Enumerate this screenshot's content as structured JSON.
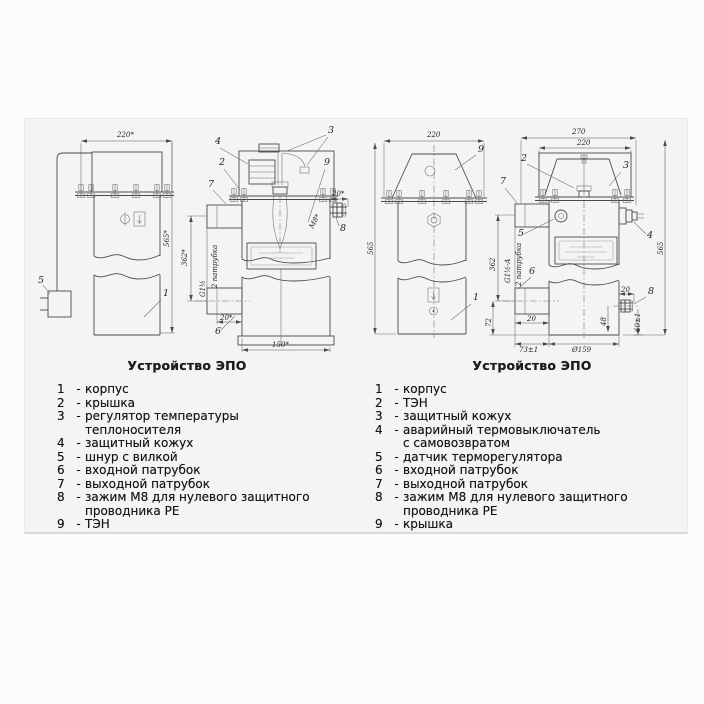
{
  "ui": {
    "dash": "-"
  },
  "fig1": {
    "caption": "Устройство ЭПО",
    "dims": {
      "top_width": "220*",
      "height": "565*",
      "mid_height": "362*",
      "bottom_width": "150*",
      "stud_thread": "М8*",
      "stud_len": "20*",
      "pipe_len": "20*",
      "pipe_thread": "G1½",
      "pipe_note": "2 патрубка"
    },
    "callouts": {
      "c1": "1",
      "c2": "2",
      "c3": "3",
      "c4": "4",
      "c5": "5",
      "c6": "6",
      "c7": "7",
      "c8": "8",
      "c9": "9"
    },
    "parts": [
      {
        "n": "1",
        "t": "корпус"
      },
      {
        "n": "2",
        "t": "крышка"
      },
      {
        "n": "3",
        "t": "регулятор температуры теплоносителя"
      },
      {
        "n": "4",
        "t": "защитный кожух"
      },
      {
        "n": "5",
        "t": "шнур с вилкой"
      },
      {
        "n": "6",
        "t": "входной патрубок"
      },
      {
        "n": "7",
        "t": "выходной патрубок"
      },
      {
        "n": "8",
        "t": "зажим М8 для нулевого защитного проводника РЕ"
      },
      {
        "n": "9",
        "t": "ТЭН"
      }
    ]
  },
  "fig2": {
    "caption": "Устройство ЭПО",
    "dims": {
      "outer_width": "270",
      "top_width": "220",
      "height": "565",
      "height_right": "565",
      "mid_height": "362",
      "inlet_offset": "72",
      "bottom_left": "73±1",
      "diameter": "Ø159",
      "pipe_thread": "G1½-A",
      "pipe_note": "2 патрубка",
      "pipe_len": "20",
      "stud_len": "20",
      "stud_drop": "48",
      "stud_pos": "60±1"
    },
    "callouts": {
      "c1": "1",
      "c2": "2",
      "c3": "3",
      "c4": "4",
      "c5": "5",
      "c6": "6",
      "c7": "7",
      "c8": "8",
      "c9": "9"
    },
    "parts": [
      {
        "n": "1",
        "t": "корпус"
      },
      {
        "n": "2",
        "t": "ТЭН"
      },
      {
        "n": "3",
        "t": "защитный кожух"
      },
      {
        "n": "4",
        "t": "аварийный термовыключатель с самовозвратом"
      },
      {
        "n": "5",
        "t": "датчик терморегулятора"
      },
      {
        "n": "6",
        "t": "входной патрубок"
      },
      {
        "n": "7",
        "t": "выходной патрубок"
      },
      {
        "n": "8",
        "t": "зажим М8 для нулевого защитного проводника РЕ"
      },
      {
        "n": "9",
        "t": "крышка"
      }
    ]
  }
}
